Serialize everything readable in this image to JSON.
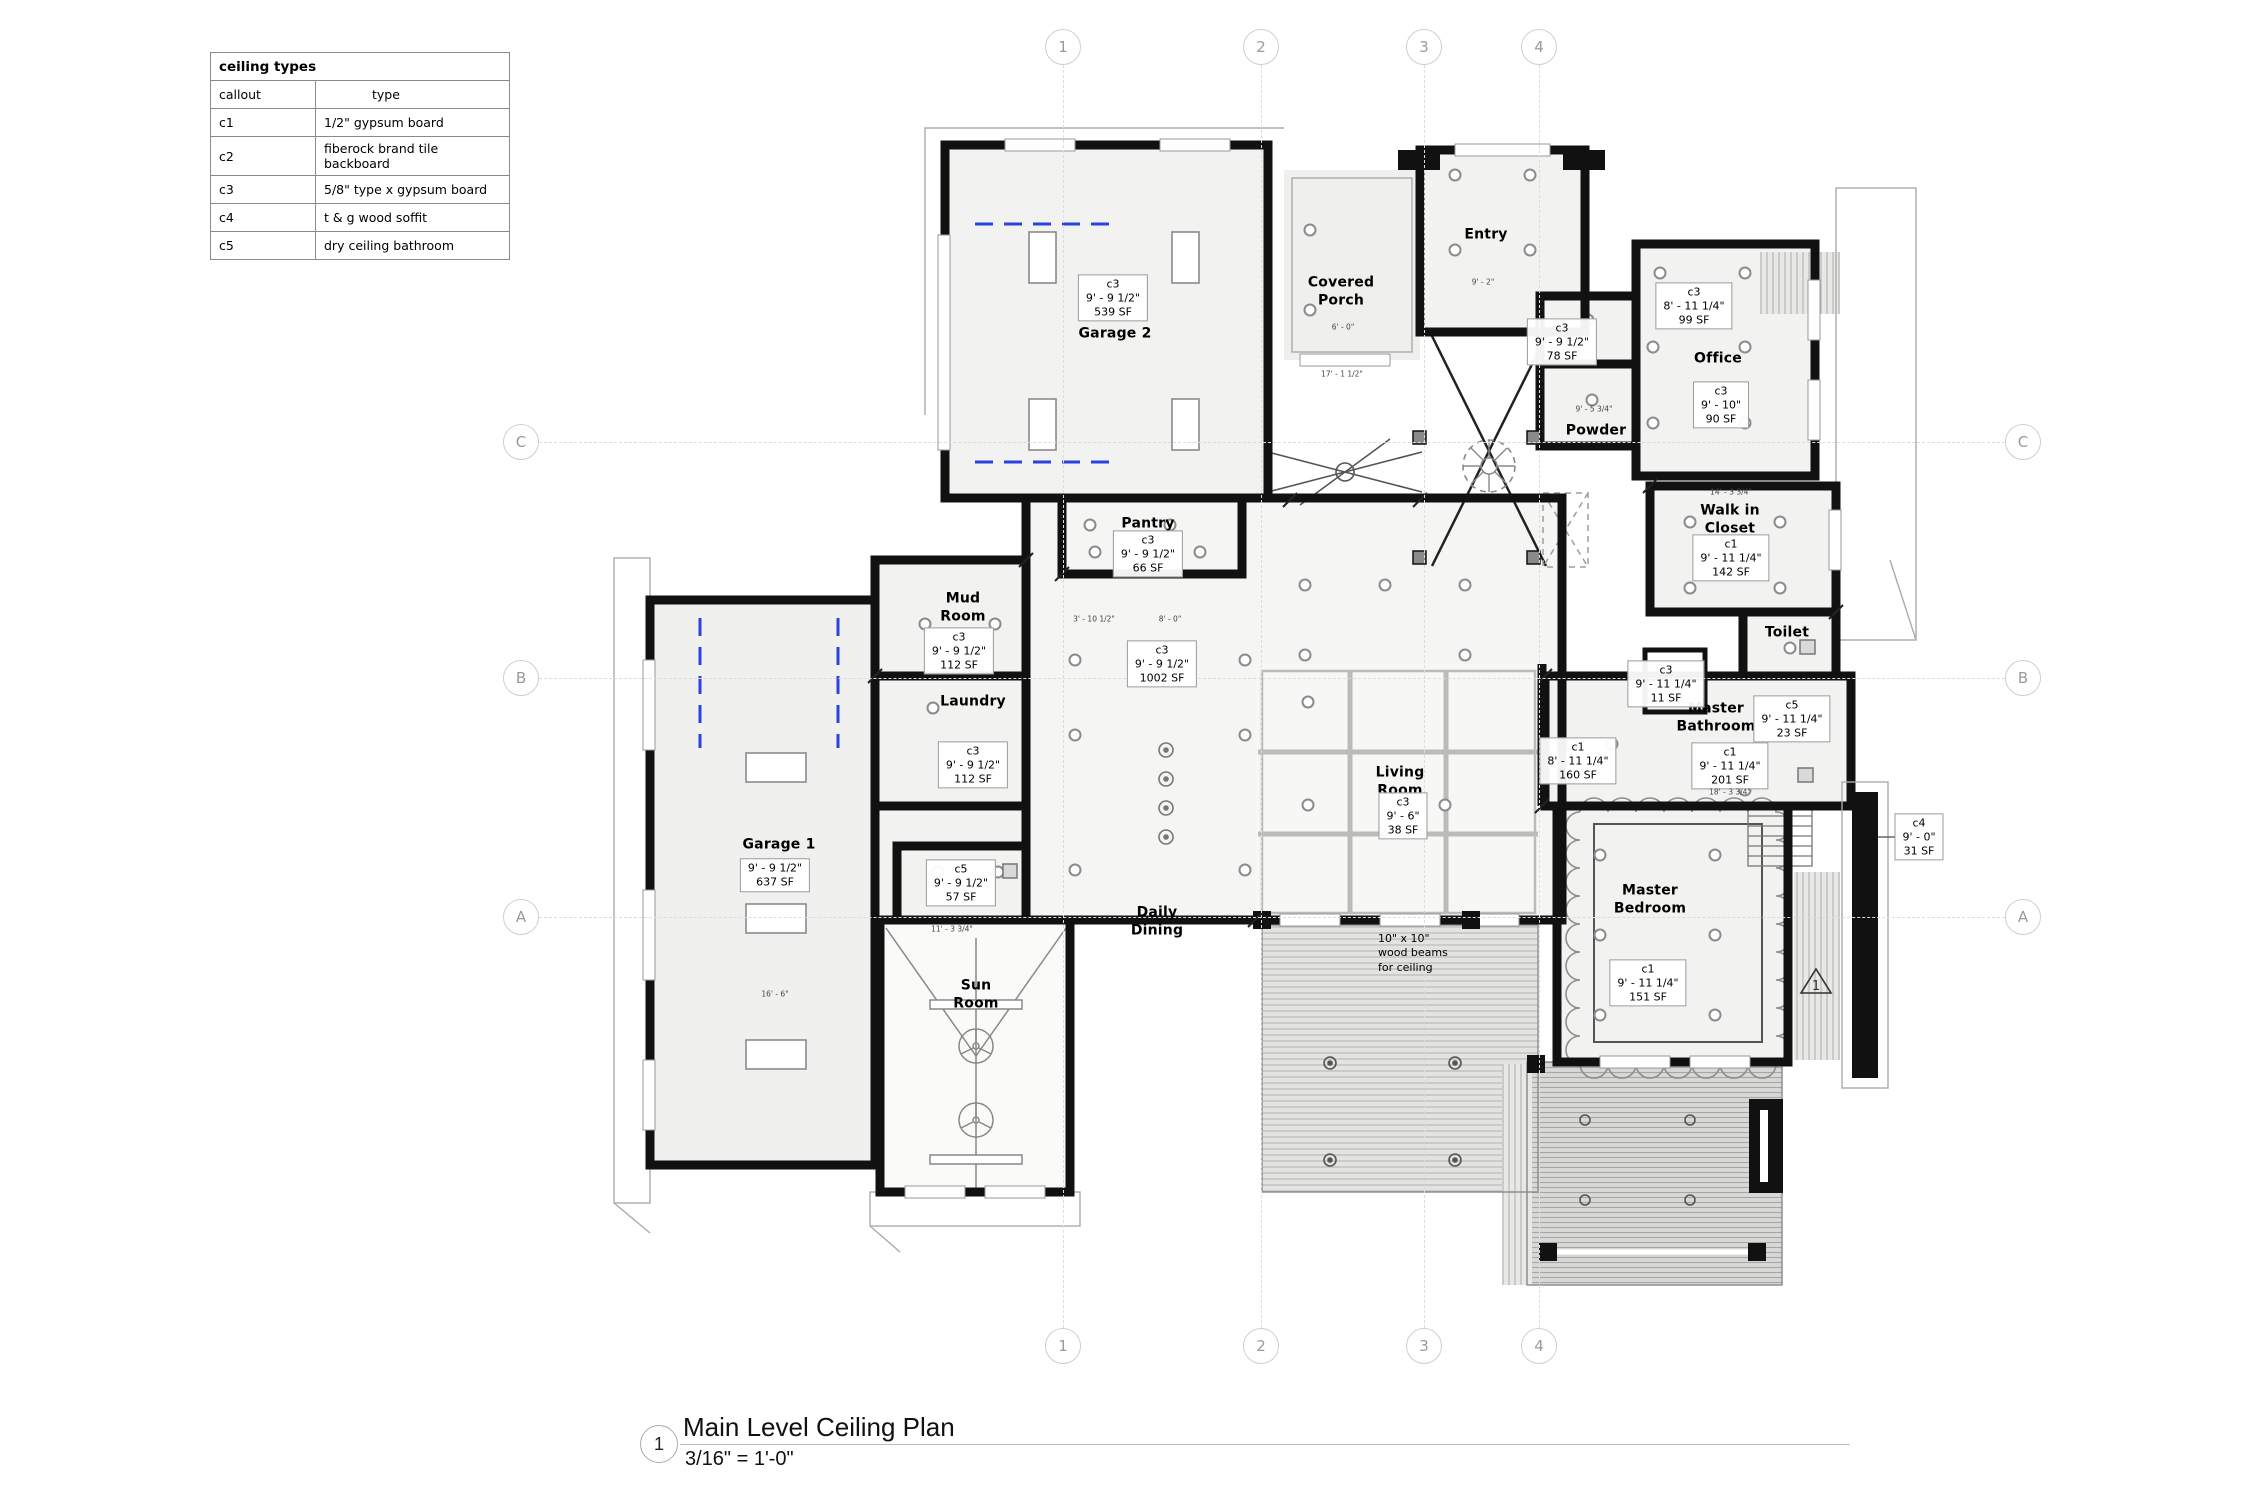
{
  "legend": {
    "title": "ceiling types",
    "col_callout": "callout",
    "col_type": "type",
    "rows": [
      {
        "callout": "c1",
        "type": "1/2\" gypsum board"
      },
      {
        "callout": "c2",
        "type": "fiberock brand tile backboard"
      },
      {
        "callout": "c3",
        "type": "5/8\" type x gypsum board"
      },
      {
        "callout": "c4",
        "type": "t & g wood soffit"
      },
      {
        "callout": "c5",
        "type": "dry ceiling bathroom"
      }
    ]
  },
  "grid": {
    "columns": [
      {
        "label": "1",
        "x": 1063
      },
      {
        "label": "2",
        "x": 1261
      },
      {
        "label": "3",
        "x": 1424
      },
      {
        "label": "4",
        "x": 1539
      }
    ],
    "rows": [
      {
        "label": "C",
        "y": 442
      },
      {
        "label": "B",
        "y": 678
      },
      {
        "label": "A",
        "y": 917
      }
    ],
    "top_y": 47,
    "bottom_y": 1346,
    "left_x": 521,
    "right_x": 2023
  },
  "rooms": [
    {
      "name": "Garage 2",
      "x": 1115,
      "y": 334
    },
    {
      "name": "Covered\nPorch",
      "x": 1341,
      "y": 292
    },
    {
      "name": "Entry",
      "x": 1486,
      "y": 235
    },
    {
      "name": "Powder",
      "x": 1596,
      "y": 431
    },
    {
      "name": "Office",
      "x": 1718,
      "y": 359
    },
    {
      "name": "Walk in\nCloset",
      "x": 1730,
      "y": 520
    },
    {
      "name": "Toilet",
      "x": 1787,
      "y": 633
    },
    {
      "name": "Master\nBathroom",
      "x": 1716,
      "y": 718
    },
    {
      "name": "Master\nBedroom",
      "x": 1650,
      "y": 900
    },
    {
      "name": "Pantry",
      "x": 1148,
      "y": 524
    },
    {
      "name": "Mud\nRoom",
      "x": 963,
      "y": 608
    },
    {
      "name": "Laundry",
      "x": 973,
      "y": 702
    },
    {
      "name": "Garage 1",
      "x": 779,
      "y": 845
    },
    {
      "name": "Sun\nRoom",
      "x": 976,
      "y": 995
    },
    {
      "name": "Daily\nDining",
      "x": 1157,
      "y": 922
    },
    {
      "name": "Living\nRoom",
      "x": 1400,
      "y": 782
    }
  ],
  "callouts": [
    {
      "code": "c3",
      "height": "9' - 9 1/2\"",
      "area": "539 SF",
      "x": 1113,
      "y": 298
    },
    {
      "code": "c3",
      "height": "9' - 9 1/2\"",
      "area": "78 SF",
      "x": 1562,
      "y": 342
    },
    {
      "code": "c3",
      "height": "8' - 11 1/4\"",
      "area": "99 SF",
      "x": 1694,
      "y": 306
    },
    {
      "code": "c3",
      "height": "9' - 10\"",
      "area": "90 SF",
      "x": 1721,
      "y": 405
    },
    {
      "code": "c1",
      "height": "9' - 11 1/4\"",
      "area": "142 SF",
      "x": 1731,
      "y": 558
    },
    {
      "code": "c3",
      "height": "9' - 11 1/4\"",
      "area": "11 SF",
      "x": 1666,
      "y": 684
    },
    {
      "code": "c5",
      "height": "9' - 11 1/4\"",
      "area": "23 SF",
      "x": 1792,
      "y": 719
    },
    {
      "code": "c1",
      "height": "9' - 11 1/4\"",
      "area": "201 SF",
      "x": 1730,
      "y": 766
    },
    {
      "code": "c1",
      "height": "8' - 11 1/4\"",
      "area": "160 SF",
      "x": 1578,
      "y": 761
    },
    {
      "code": "c1",
      "height": "9' - 11 1/4\"",
      "area": "151 SF",
      "x": 1648,
      "y": 983
    },
    {
      "code": "c3",
      "height": "9' - 9 1/2\"",
      "area": "66 SF",
      "x": 1148,
      "y": 554
    },
    {
      "code": "c3",
      "height": "9' - 9 1/2\"",
      "area": "112 SF",
      "x": 959,
      "y": 651
    },
    {
      "code": "c3",
      "height": "9' - 9 1/2\"",
      "area": "112 SF",
      "x": 973,
      "y": 765
    },
    {
      "code": "c3",
      "height": "9' - 9 1/2\"",
      "area": "1002 SF",
      "x": 1162,
      "y": 664
    },
    {
      "code": "",
      "height": "9' - 9 1/2\"",
      "area": "637 SF",
      "x": 775,
      "y": 875
    },
    {
      "code": "c5",
      "height": "9' - 9 1/2\"",
      "area": "57 SF",
      "x": 961,
      "y": 883
    },
    {
      "code": "c3",
      "height": "9' - 6\"",
      "area": "38 SF",
      "x": 1403,
      "y": 816
    },
    {
      "code": "c4",
      "height": "9' - 0\"",
      "area": "31 SF",
      "x": 1919,
      "y": 837
    }
  ],
  "notes": [
    {
      "text": "10\" x 10\"\nwood beams\nfor ceiling",
      "x": 1378,
      "y": 932
    }
  ],
  "dims": [
    {
      "text": "6' - 0\"",
      "x": 1343,
      "y": 327
    },
    {
      "text": "17' - 1 1/2\"",
      "x": 1342,
      "y": 374
    },
    {
      "text": "9' - 2\"",
      "x": 1483,
      "y": 282
    },
    {
      "text": "9' - 5 3/4\"",
      "x": 1594,
      "y": 409
    },
    {
      "text": "14' - 3 3/4\"",
      "x": 1731,
      "y": 492
    },
    {
      "text": "18' - 3 3/4\"",
      "x": 1730,
      "y": 792
    },
    {
      "text": "11' - 3 3/4\"",
      "x": 952,
      "y": 929
    },
    {
      "text": "16' - 6\"",
      "x": 775,
      "y": 994
    },
    {
      "text": "3' - 10 1/2\"",
      "x": 1094,
      "y": 619
    },
    {
      "text": "8' - 0\"",
      "x": 1170,
      "y": 619
    }
  ],
  "rev": {
    "label": "1",
    "x": 1799,
    "y": 966
  },
  "title_block": {
    "number": "1",
    "title": "Main Level Ceiling Plan",
    "scale": "3/16\" = 1'-0\""
  },
  "colors": {
    "wall": "#111111",
    "room_fill": "#f2f2f0",
    "accent_blue": "#2a43e0",
    "grid_gray": "#dcdcdc"
  }
}
